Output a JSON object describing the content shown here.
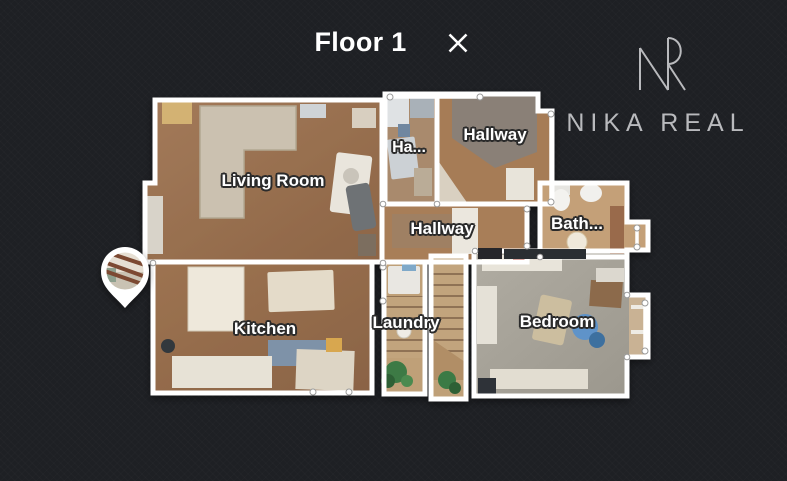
{
  "header": {
    "title": "Floor 1",
    "close_label": "Close floor plan"
  },
  "brand": {
    "monogram": "NR",
    "name": "NIKA REAL",
    "color": "#b9babd"
  },
  "floorplan": {
    "floor_label": "Floor 1",
    "rooms": [
      {
        "id": "living-room",
        "label": "Living Room"
      },
      {
        "id": "hallway-small",
        "label": "Ha..."
      },
      {
        "id": "hallway-upper",
        "label": "Hallway"
      },
      {
        "id": "hallway-main",
        "label": "Hallway"
      },
      {
        "id": "bathroom",
        "label": "Bath..."
      },
      {
        "id": "kitchen",
        "label": "Kitchen"
      },
      {
        "id": "laundry",
        "label": "Laundry"
      },
      {
        "id": "bedroom",
        "label": "Bedroom"
      }
    ],
    "marker": {
      "icon": "location-pin",
      "content": "panorama-thumbnail"
    }
  },
  "colors": {
    "background": "#1e2024",
    "wall": "#ffffff",
    "wood_floor": "#9c7252",
    "carpet": "#a8a49b",
    "title_text": "#ffffff",
    "brand_text": "#b9babd"
  }
}
